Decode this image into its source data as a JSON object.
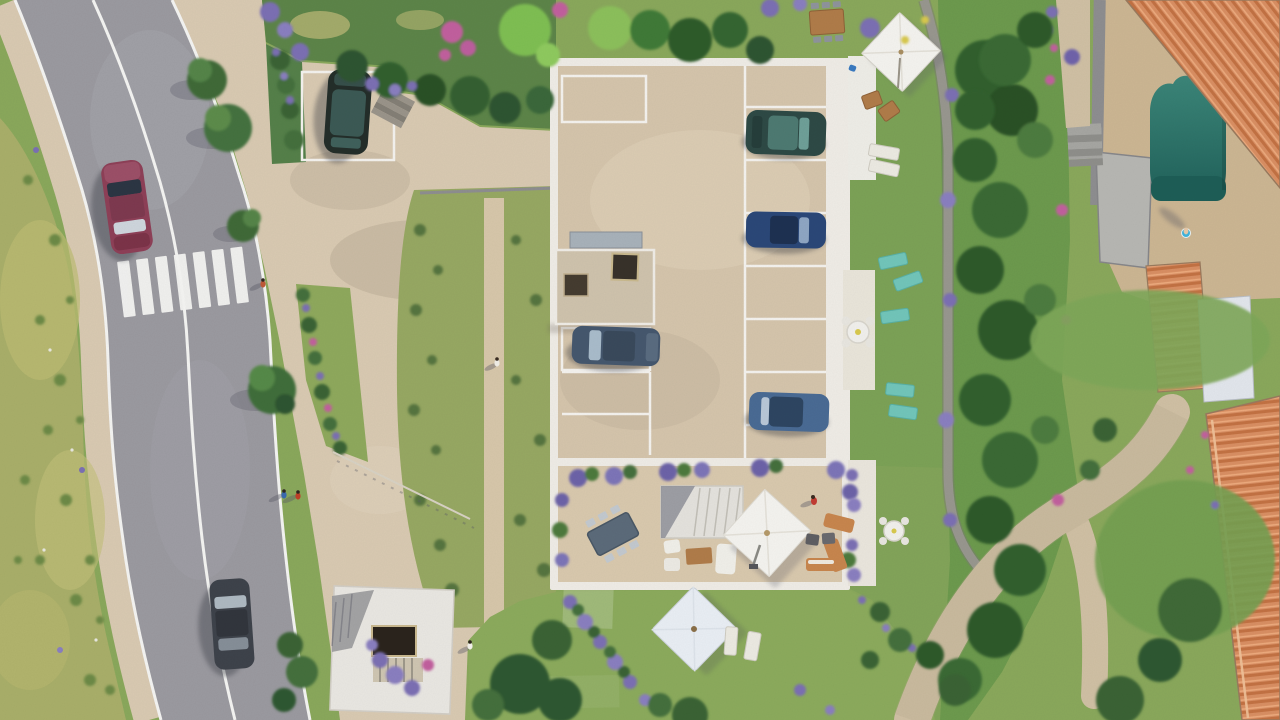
{
  "scene": {
    "description": "Aerial top-down 3D architectural rendering of a residential development: a flat-roof building with a rooftop parking court and landscaped gardens, bordered on the left by a curved two-lane road with a zebra crossing, and on the right by neighbouring villas with terracotta tile roofs and a swimming pool.",
    "view": "top-down aerial",
    "style": "photorealistic 3D render",
    "road": {
      "lanes": 2,
      "markings": [
        "solid white edge lines",
        "solid white center line",
        "zebra crossing"
      ],
      "vehicles": [
        {
          "name": "red-car",
          "color": "#8e4058",
          "heading": "south"
        },
        {
          "name": "dark-gray-car",
          "color": "#3e434b",
          "heading": "north"
        }
      ]
    },
    "building": {
      "type": "flat-roof residence with parking court and roof terrace",
      "parked_cars": [
        {
          "name": "black-suv",
          "color": "#242e2a"
        },
        {
          "name": "teal-sedan",
          "color": "#2e4a46"
        },
        {
          "name": "blue-sedan",
          "color": "#2b4878"
        },
        {
          "name": "slate-car",
          "color": "#46586e"
        },
        {
          "name": "steel-blue-car",
          "color": "#4a6b94"
        }
      ],
      "skylights": 2,
      "features": [
        "terrace dining set",
        "square white parasol",
        "outdoor staircase",
        "white lounge set",
        "orange loungers"
      ]
    },
    "amenities": {
      "swimming_pool_color": "#2e7d71",
      "teal_sun_loungers": 5,
      "white_parasols": 3,
      "outdoor_tables": 4
    },
    "people_visible": 8,
    "neighbourhood": {
      "terracotta_roofs": 3,
      "footpaths": [
        "gray garden path",
        "curved beige walkway"
      ]
    }
  },
  "palette": {
    "grass_base": "#8aa85c",
    "grass_dry": "#a9af6a",
    "lawn": "#8cab5d",
    "veg_band": "#6d9a4e",
    "road": "#9b9aa0",
    "road_marking": "#f4f4f2",
    "pavement": "#d9cab2",
    "courtyard": "#d5c5ac",
    "terrace": "#d9c9ae",
    "building_white": "#efece6",
    "roof_structure": "#cfc3ad",
    "pool_deck": "#ccb693",
    "pool_dark": "#1e5e57",
    "walkway": "#d0c0a4",
    "path_gray": "#98978f",
    "car_red": "#8e4058",
    "car_black": "#242e2a",
    "car_teal": "#2e4a46",
    "car_blue": "#2b4878",
    "car_steel": "#4a6b94",
    "car_slate": "#46586e",
    "car_gray": "#3e434b",
    "lounger_teal": "#72c6ba",
    "wood": "#b07c4a",
    "umbrella_white": "#f4f3ef",
    "flower_purple": "#7b70b4",
    "flower_pink": "#c2619e"
  }
}
